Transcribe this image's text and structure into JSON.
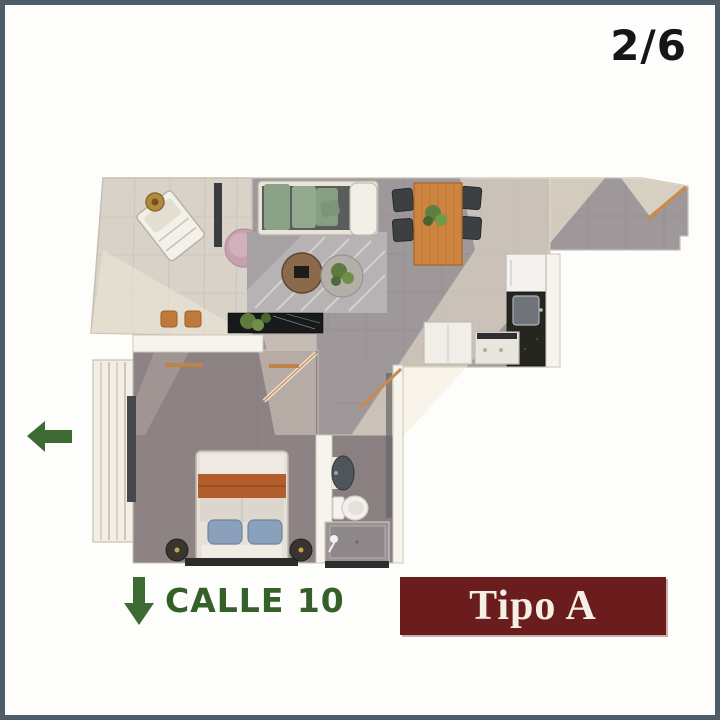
{
  "frame": {
    "border_color": "#4e5d6a",
    "background": "#fdfdfb"
  },
  "header": {
    "page_indicator": "2/6"
  },
  "street": {
    "label": "CALLE 10",
    "color": "#36602a",
    "arrow_direction": "down"
  },
  "orientation_arrow": {
    "direction": "left",
    "color": "#3e6b33"
  },
  "banner": {
    "label": "Tipo A",
    "bg_color": "#6b1d1e",
    "text_color": "#f4efe5"
  },
  "floor_plan": {
    "depicted_rooms": [
      "terrace",
      "living-room",
      "dining-area",
      "kitchen",
      "entry-hall",
      "bedroom",
      "bathroom"
    ],
    "depicted_furniture": [
      "lounge-chair",
      "side-table",
      "pouf",
      "sofa",
      "rug",
      "coffee-tables",
      "planter",
      "stools",
      "dining-table",
      "dining-chairs",
      "fridge",
      "kitchen-counter-sink",
      "cabinets",
      "stove",
      "bed",
      "nightstands",
      "window-band",
      "bathroom-sink",
      "toilet",
      "shower"
    ]
  }
}
